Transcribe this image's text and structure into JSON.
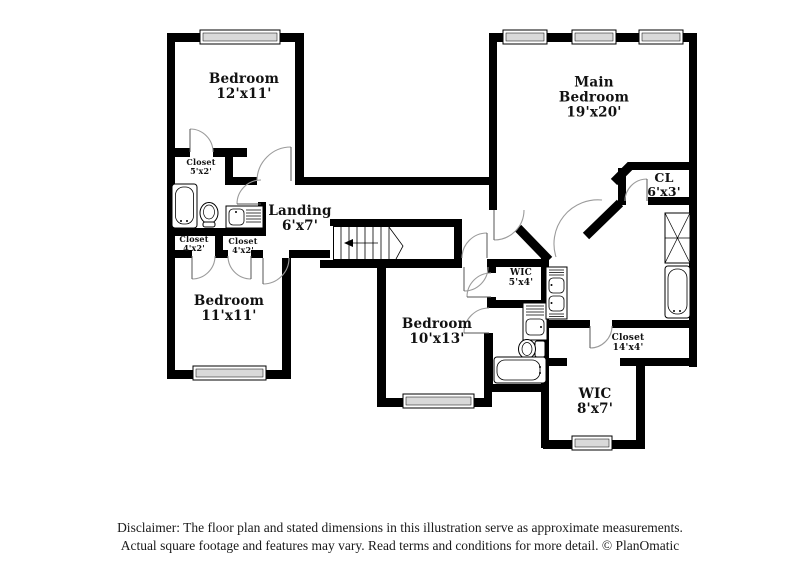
{
  "colors": {
    "background": "#ffffff",
    "wall": "#000000",
    "window_fill": "#d9d9d9",
    "door_arc": "#9b9b9b"
  },
  "rooms": [
    {
      "id": "bedroom-top-left",
      "name": "Bedroom",
      "dims": "12'x11'"
    },
    {
      "id": "main-bedroom",
      "name": "Main Bedroom",
      "dims": "19'x20'"
    },
    {
      "id": "landing",
      "name": "Landing",
      "dims": "6'x7'"
    },
    {
      "id": "closet-5x2",
      "name": "Closet",
      "dims": "5'x2'"
    },
    {
      "id": "closet-4x2-left",
      "name": "Closet",
      "dims": "4'x2'"
    },
    {
      "id": "closet-4x2-right",
      "name": "Closet",
      "dims": "4'x2'"
    },
    {
      "id": "bedroom-bottom-left",
      "name": "Bedroom",
      "dims": "11'x11'"
    },
    {
      "id": "bedroom-center",
      "name": "Bedroom",
      "dims": "10'x13'"
    },
    {
      "id": "wic-5x4",
      "name": "WIC",
      "dims": "5'x4'"
    },
    {
      "id": "cl-6x3",
      "name": "CL",
      "dims": "6'x3'"
    },
    {
      "id": "closet-14x4",
      "name": "Closet",
      "dims": "14'x4'"
    },
    {
      "id": "wic-8x7",
      "name": "WIC",
      "dims": "8'x7'"
    }
  ],
  "disclaimer": {
    "line1": "Disclaimer: The floor plan and stated dimensions in this illustration serve as approximate measurements.",
    "line2": "Actual square footage and features may vary. Read terms and conditions for more detail. © PlanOmatic"
  }
}
